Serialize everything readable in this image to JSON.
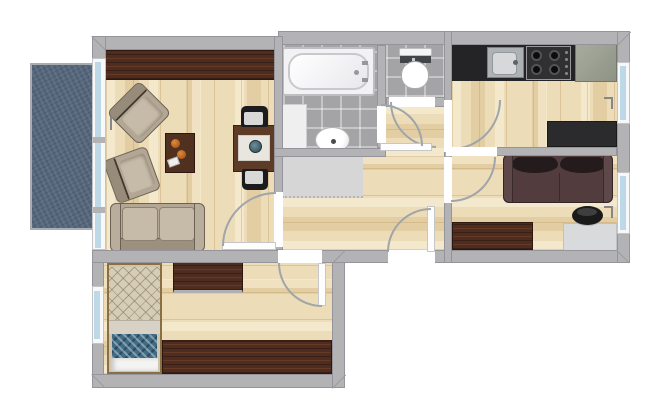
{
  "meta": {
    "kind": "apartment-floor-plan",
    "text_labels_visible": "none"
  },
  "palette": {
    "wall": "#b3b3b5",
    "wallEdge": "#94949a",
    "wood": "#ecdcb8",
    "tile": "#a4a4a6",
    "balcony": "#54667b",
    "mahogany": "#4e2c20",
    "beige": "#b3a694",
    "darkSofa": "#523c3d",
    "darkCushion": "#241b1d",
    "counterBlack": "#242426",
    "steel": "#aeb2b4",
    "glass": "#bdd8e6",
    "mat": "#d6d6d6",
    "blanket": "#3f6b85",
    "grayCabinet": "#9da294",
    "desk": "#d9dadb",
    "arc": "#9fa5a9"
  },
  "rooms": [
    {
      "id": "balcony",
      "name": "balcony",
      "floor": "concrete-blue"
    },
    {
      "id": "living-room",
      "name": "living room",
      "floor": "wood"
    },
    {
      "id": "bathroom",
      "name": "bathroom",
      "floor": "gray-tile"
    },
    {
      "id": "wc",
      "name": "toilet room",
      "floor": "gray-tile"
    },
    {
      "id": "vestibule",
      "name": "bath/wc vestibule",
      "floor": "wood"
    },
    {
      "id": "hallway",
      "name": "hallway",
      "floor": "wood"
    },
    {
      "id": "kitchen",
      "name": "kitchen",
      "floor": "wood"
    },
    {
      "id": "bedroom-right",
      "name": "right bedroom / study",
      "floor": "wood"
    },
    {
      "id": "bedroom-left",
      "name": "lower bedroom",
      "floor": "wood"
    }
  ],
  "furniture": {
    "living_room": [
      "sideboard",
      "armchair",
      "armchair",
      "coffee-table",
      "decor-bowls",
      "dining-table",
      "placemat",
      "bowl",
      "chair",
      "chair",
      "sofa-beige"
    ],
    "bathroom": [
      "bathtub",
      "cabinet",
      "washbasin"
    ],
    "wc": [
      "toilet"
    ],
    "kitchen": [
      "counter-black",
      "sink-unit",
      "gas-hob-4-burners",
      "corner-cabinet",
      "table-black"
    ],
    "bedroom_right": [
      "sofa-dark-brown",
      "dresser",
      "desk",
      "desk-chair"
    ],
    "bedroom_left": [
      "single-bed",
      "dresser",
      "wardrobe"
    ]
  },
  "openings": {
    "doors": [
      "living-room-door",
      "bedroom-left-door",
      "front-door",
      "wc-door",
      "bathroom-door",
      "kitchen-door",
      "bedroom-right-door"
    ],
    "windows": [
      "balcony-window-wall",
      "bedroom-left-window",
      "kitchen-window",
      "bedroom-right-window"
    ]
  }
}
